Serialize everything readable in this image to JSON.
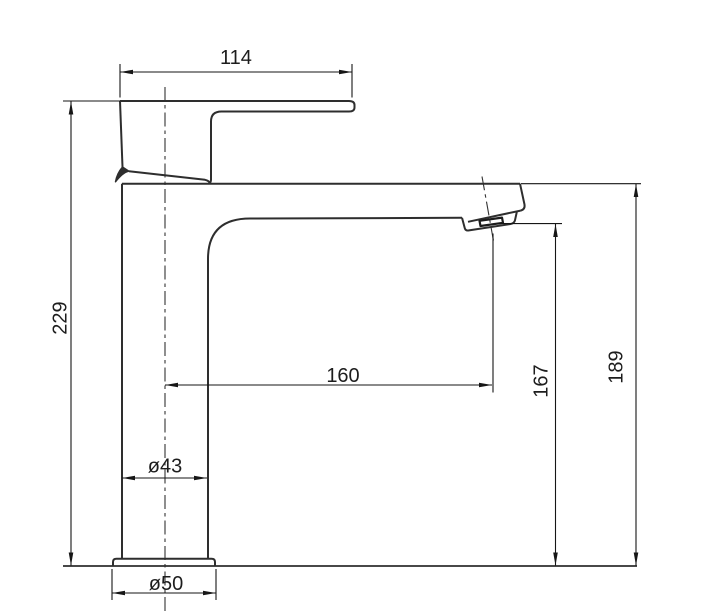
{
  "drawing": {
    "dimensions": {
      "handle_length": "114",
      "overall_height": "229",
      "spout_reach": "160",
      "outlet_height": "167",
      "spout_height": "189",
      "body_diameter": "ø43",
      "base_diameter": "ø50"
    },
    "colors": {
      "outline": "#2e2e2e",
      "dimension_lines": "#161616",
      "background": "#ffffff"
    }
  }
}
